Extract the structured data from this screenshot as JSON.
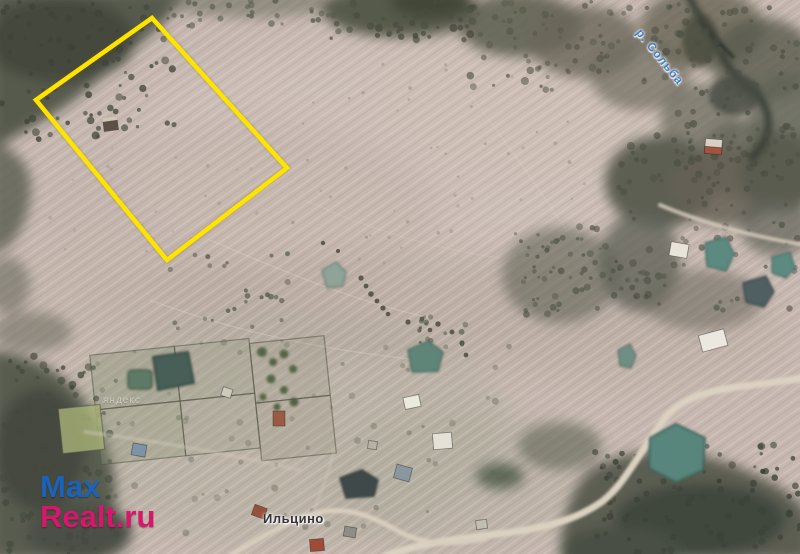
{
  "map": {
    "type": "satellite-view",
    "labels": {
      "river": "р. Сольба",
      "village": "Ильцино",
      "provider_watermark": "яндекс"
    },
    "parcel": {
      "points": "152,18 287,168 167,260 36,100",
      "outline_color": "#ffe400"
    },
    "colors": {
      "field": "#c6b8b0",
      "forest": "#5a5c50",
      "water": "#5d8b80",
      "road": "#dbd1c1",
      "river_label_blue": "#3f7ec9",
      "village_label": "#34343a"
    },
    "watermark": {
      "line1": "Max",
      "line2": "Realt.ru",
      "line1_color": "#1b63b8",
      "line2_color": "#d6176b"
    }
  }
}
